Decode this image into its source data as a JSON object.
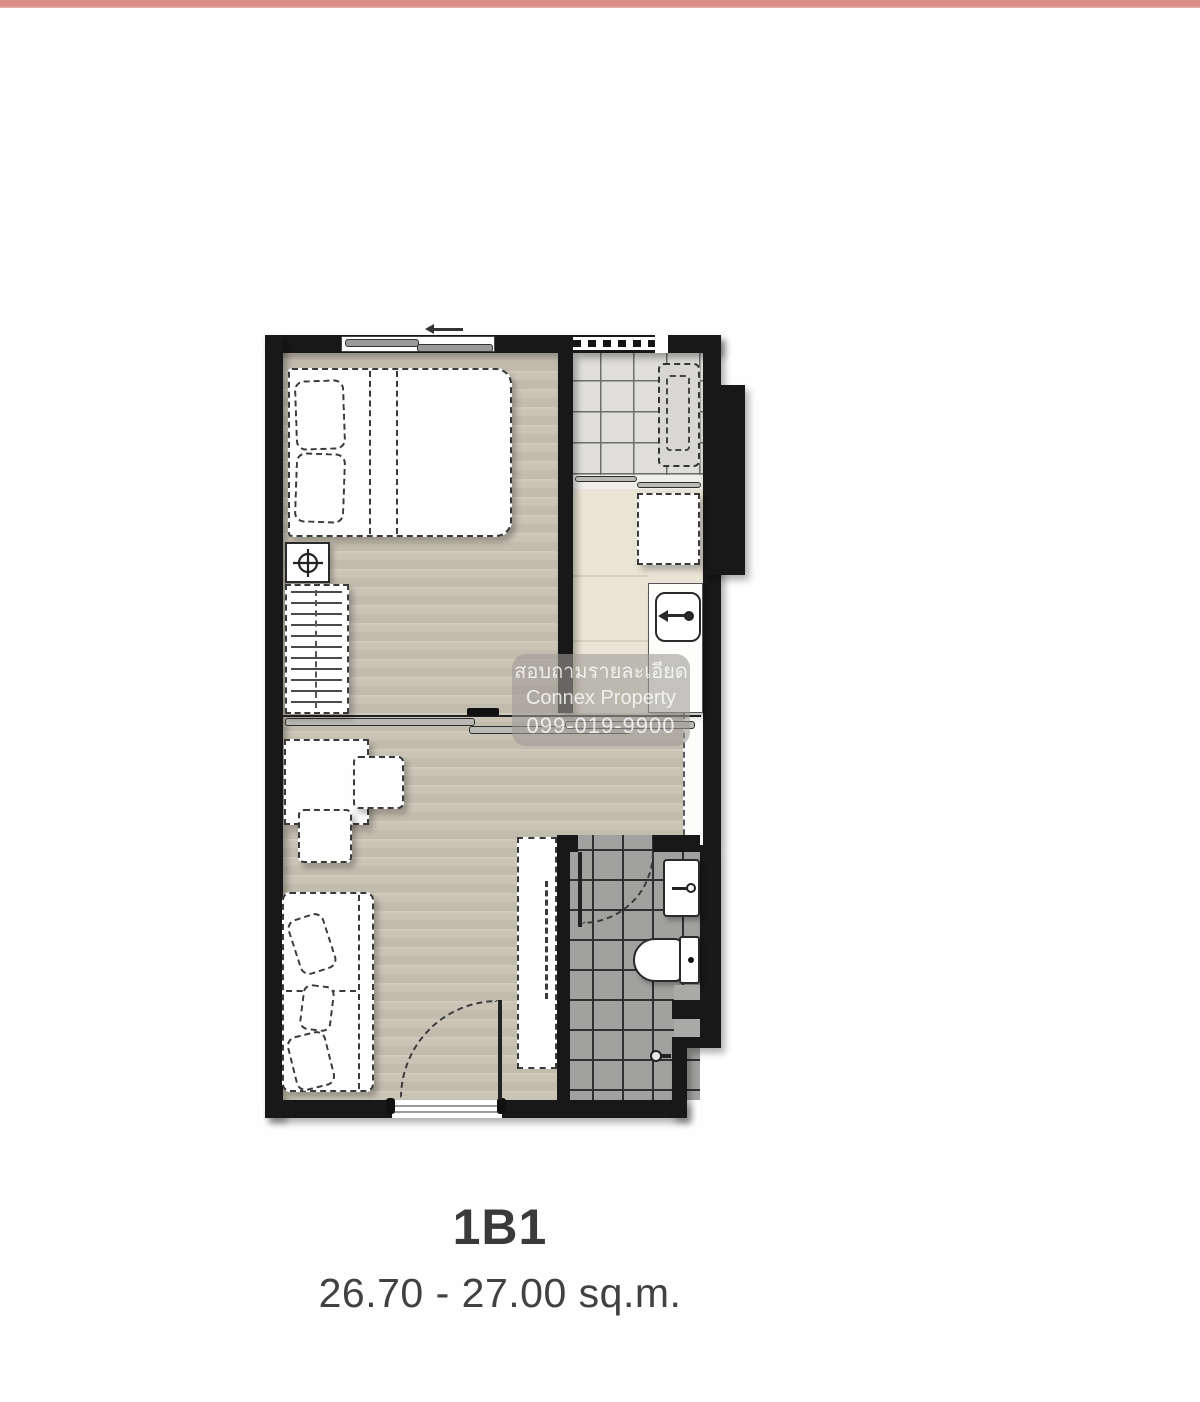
{
  "page": {
    "top_bar_color": "#d88e85",
    "background": "#fefefe"
  },
  "unit": {
    "name": "1B1",
    "area": "26.70 - 27.00 sq.m."
  },
  "watermark": {
    "line1": "สอบถามรายละเอียด",
    "line2": "Connex Property",
    "line3": "099-019-9900"
  },
  "floorplan": {
    "type": "condo-unit-floor-plan",
    "colors": {
      "wall": "#181818",
      "wood_floor": "#cbc4b6",
      "balcony_tile": "#dfdedb",
      "kitchen_floor": "#e9e5d6",
      "bathroom_tile": "#a1a19f",
      "furniture_fill": "#fefefe"
    },
    "elements": [
      "window",
      "double-bed",
      "pillows",
      "nightstand-lamp",
      "wardrobe",
      "sliding-partition-door",
      "desk",
      "chair",
      "stool",
      "sofa",
      "sofa-pillows",
      "entrance-door",
      "closet",
      "balcony",
      "air-conditioner",
      "balcony-sliding-door",
      "washing-machine",
      "kitchen-counter",
      "kitchen-sink",
      "bathroom",
      "bathroom-door",
      "bathroom-sink",
      "toilet",
      "shower-head",
      "structural-column"
    ]
  }
}
